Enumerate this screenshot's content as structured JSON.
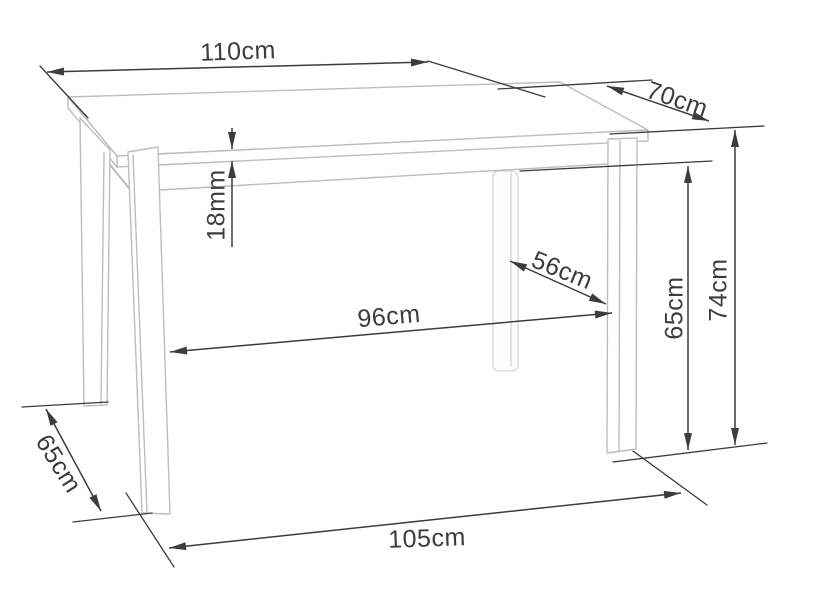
{
  "diagram": {
    "subject": "table-dimension-drawing",
    "colors": {
      "background": "#ffffff",
      "dimension": "#3c3c3c",
      "table_outline": "#bdbdbd",
      "hidden_outline": "#d6d6d6"
    },
    "dimensions": [
      {
        "id": "tabletop-width",
        "label": "110cm"
      },
      {
        "id": "tabletop-depth",
        "label": "70cm"
      },
      {
        "id": "tabletop-thickness",
        "label": "18mm"
      },
      {
        "id": "legs-gap-depth",
        "label": "56cm"
      },
      {
        "id": "legs-gap-width",
        "label": "96cm"
      },
      {
        "id": "underframe-clearance-height",
        "label": "65cm"
      },
      {
        "id": "overall-height",
        "label": "74cm"
      },
      {
        "id": "legs-span-depth-floor",
        "label": "65cm"
      },
      {
        "id": "legs-span-width-floor",
        "label": "105cm"
      }
    ]
  }
}
